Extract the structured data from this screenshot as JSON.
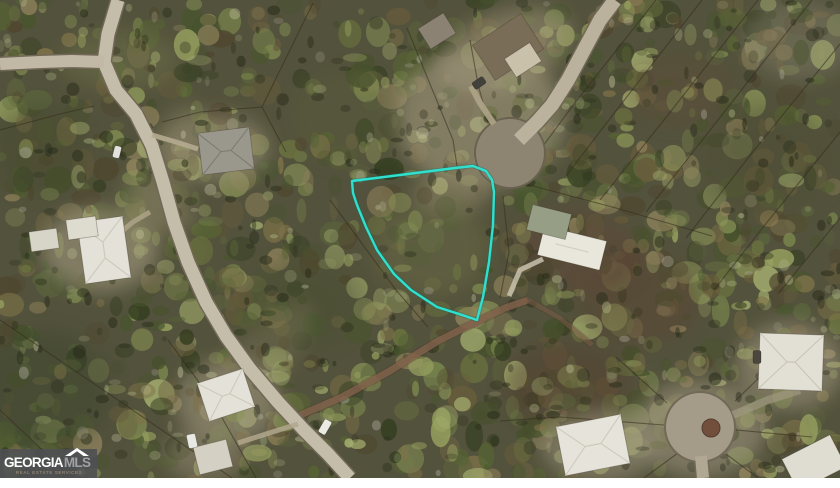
{
  "image": {
    "width": 840,
    "height": 488,
    "photo_height": 478,
    "border_color": "#ffffff"
  },
  "watermark": {
    "brand_primary": "GEORGIA",
    "brand_secondary": "MLS",
    "tagline": "REAL ESTATE SERVICES",
    "roof_icon": "roof-chevron",
    "bg_color": "#4f5054",
    "primary_color": "#ffffff",
    "secondary_color": "#9fa1a5",
    "tagline_color": "#8f8072"
  },
  "map": {
    "type": "aerial-photo",
    "base_color": "#4e4e38",
    "tint": {
      "color": "#9a9478",
      "opacity": 0.07
    },
    "texture": {
      "seed": 1337,
      "blob_count": 950,
      "canopy_count": 260,
      "shadow_count": 330,
      "highlight_count": 150,
      "palette": [
        "#66703c",
        "#51602f",
        "#75834a",
        "#3f4c26",
        "#8a9656",
        "#2f3a1d",
        "#7c7046",
        "#635838",
        "#97a25f",
        "#4b422b",
        "#a3ae6e",
        "#56603a",
        "#8d815a",
        "#42512a"
      ],
      "shadow_color": "#1d2212",
      "highlight_colors": [
        "#b6bd8d",
        "#c6c6a0",
        "#a9b184",
        "#b0ada0"
      ]
    },
    "clearings": [
      {
        "cx": 480,
        "cy": 118,
        "rx": 85,
        "ry": 70,
        "color": "#b2a88c",
        "op": 0.5,
        "rot": 0
      },
      {
        "cx": 505,
        "cy": 50,
        "rx": 70,
        "ry": 38,
        "color": "#a89c80",
        "op": 0.45,
        "rot": -20
      },
      {
        "cx": 215,
        "cy": 148,
        "rx": 55,
        "ry": 35,
        "color": "#a79d84",
        "op": 0.45,
        "rot": 0
      },
      {
        "cx": 100,
        "cy": 250,
        "rx": 58,
        "ry": 42,
        "color": "#b0a78c",
        "op": 0.5,
        "rot": 0
      },
      {
        "cx": 160,
        "cy": 205,
        "rx": 40,
        "ry": 25,
        "color": "#9a906f",
        "op": 0.35,
        "rot": 30
      },
      {
        "cx": 578,
        "cy": 252,
        "rx": 62,
        "ry": 40,
        "color": "#5d4034",
        "op": 0.5,
        "rot": 10
      },
      {
        "cx": 640,
        "cy": 300,
        "rx": 60,
        "ry": 45,
        "color": "#573d2f",
        "op": 0.4,
        "rot": 0
      },
      {
        "cx": 566,
        "cy": 385,
        "rx": 62,
        "ry": 42,
        "color": "#50372a",
        "op": 0.45,
        "rot": 0
      },
      {
        "cx": 680,
        "cy": 90,
        "rx": 55,
        "ry": 35,
        "color": "#5e4634",
        "op": 0.3,
        "rot": 0
      },
      {
        "cx": 700,
        "cy": 428,
        "rx": 66,
        "ry": 48,
        "color": "#a29983",
        "op": 0.55,
        "rot": 0
      },
      {
        "cx": 228,
        "cy": 402,
        "rx": 52,
        "ry": 42,
        "color": "#a89f87",
        "op": 0.5,
        "rot": 0
      },
      {
        "cx": 205,
        "cy": 455,
        "rx": 40,
        "ry": 26,
        "color": "#9c9279",
        "op": 0.45,
        "rot": 0
      },
      {
        "cx": 790,
        "cy": 366,
        "rx": 54,
        "ry": 44,
        "color": "#a79d86",
        "op": 0.5,
        "rot": 0
      },
      {
        "cx": 600,
        "cy": 446,
        "rx": 58,
        "ry": 36,
        "color": "#a39a83",
        "op": 0.5,
        "rot": 0
      },
      {
        "cx": 430,
        "cy": 248,
        "rx": 58,
        "ry": 48,
        "color": "#6d6e46",
        "op": 0.4,
        "rot": 0
      },
      {
        "cx": 452,
        "cy": 192,
        "rx": 38,
        "ry": 22,
        "color": "#9a9171",
        "op": 0.45,
        "rot": 0
      },
      {
        "cx": 345,
        "cy": 118,
        "rx": 55,
        "ry": 45,
        "color": "#585c38",
        "op": 0.35,
        "rot": 0
      },
      {
        "cx": 42,
        "cy": 390,
        "rx": 70,
        "ry": 60,
        "color": "#39422a",
        "op": 0.5,
        "rot": 0
      },
      {
        "cx": 770,
        "cy": 160,
        "rx": 65,
        "ry": 55,
        "color": "#49482e",
        "op": 0.4,
        "rot": 0
      },
      {
        "cx": 800,
        "cy": 40,
        "rx": 55,
        "ry": 40,
        "color": "#8d8a76",
        "op": 0.35,
        "rot": 0
      },
      {
        "cx": 300,
        "cy": 305,
        "rx": 60,
        "ry": 45,
        "color": "#424b2a",
        "op": 0.4,
        "rot": 0
      },
      {
        "cx": 120,
        "cy": 60,
        "rx": 60,
        "ry": 30,
        "color": "#7d8251",
        "op": 0.3,
        "rot": 0
      },
      {
        "cx": 40,
        "cy": 150,
        "rx": 45,
        "ry": 45,
        "color": "#3c4527",
        "op": 0.4,
        "rot": 0
      },
      {
        "cx": 160,
        "cy": 180,
        "rx": 26,
        "ry": 85,
        "color": "#8f8868",
        "op": 0.28,
        "rot": 22
      },
      {
        "cx": 255,
        "cy": 365,
        "rx": 28,
        "ry": 80,
        "color": "#8f8868",
        "op": 0.26,
        "rot": 42
      }
    ],
    "parcel_lines": {
      "color": "#2b2416",
      "width": 1.1,
      "opacity": 0.55,
      "lines": [
        [
          [
            656,
            0
          ],
          [
            574,
            104
          ],
          [
            540,
            150
          ]
        ],
        [
          [
            702,
            0
          ],
          [
            612,
            116
          ],
          [
            566,
            176
          ]
        ],
        [
          [
            758,
            0
          ],
          [
            664,
            120
          ],
          [
            600,
            200
          ]
        ],
        [
          [
            812,
            0
          ],
          [
            718,
            120
          ],
          [
            646,
            212
          ]
        ],
        [
          [
            840,
            44
          ],
          [
            748,
            158
          ],
          [
            686,
            238
          ]
        ],
        [
          [
            840,
            132
          ],
          [
            764,
            226
          ],
          [
            714,
            290
          ]
        ],
        [
          [
            840,
            218
          ],
          [
            778,
            294
          ]
        ],
        [
          [
            518,
            182
          ],
          [
            616,
            208
          ],
          [
            712,
            236
          ]
        ],
        [
          [
            503,
            196
          ],
          [
            509,
            252
          ],
          [
            500,
            298
          ]
        ],
        [
          [
            488,
            122
          ],
          [
            478,
            84
          ],
          [
            470,
            40
          ]
        ],
        [
          [
            313,
            3
          ],
          [
            262,
            107
          ],
          [
            286,
            152
          ]
        ],
        [
          [
            407,
            28
          ],
          [
            453,
            140
          ],
          [
            457,
            166
          ]
        ],
        [
          [
            262,
            107
          ],
          [
            200,
            112
          ],
          [
            162,
            122
          ]
        ],
        [
          [
            0,
            320
          ],
          [
            118,
            400
          ],
          [
            232,
            478
          ]
        ],
        [
          [
            168,
            340
          ],
          [
            212,
            400
          ],
          [
            256,
            478
          ]
        ],
        [
          [
            0,
            410
          ],
          [
            36,
            444
          ],
          [
            70,
            478
          ]
        ],
        [
          [
            0,
            130
          ],
          [
            60,
            114
          ],
          [
            94,
            106
          ]
        ],
        [
          [
            330,
            200
          ],
          [
            396,
            290
          ],
          [
            428,
            327
          ]
        ],
        [
          [
            500,
            421
          ],
          [
            560,
            417
          ],
          [
            664,
            425
          ]
        ],
        [
          [
            667,
            403
          ],
          [
            616,
            357
          ]
        ],
        [
          [
            735,
            401
          ],
          [
            786,
            352
          ]
        ],
        [
          [
            678,
            453
          ],
          [
            644,
            478
          ]
        ],
        [
          [
            726,
            454
          ],
          [
            758,
            478
          ]
        ],
        [
          [
            736,
            430
          ],
          [
            812,
            437
          ]
        ]
      ]
    },
    "dirt_roads": [
      {
        "width": 7,
        "color": "#82604a",
        "opacity": 0.8,
        "points": [
          [
            298,
            416
          ],
          [
            340,
            398
          ],
          [
            388,
            372
          ],
          [
            438,
            341
          ],
          [
            478,
            321
          ],
          [
            505,
            308
          ],
          [
            528,
            300
          ]
        ]
      },
      {
        "width": 5,
        "color": "#7a5b46",
        "opacity": 0.55,
        "points": [
          [
            528,
            300
          ],
          [
            560,
            318
          ],
          [
            592,
            345
          ]
        ]
      }
    ],
    "roads": [
      {
        "name": "main-road",
        "width": 13,
        "color": "#c8c1ae",
        "casing": "#6e6655",
        "points": [
          [
            118,
            0
          ],
          [
            108,
            34
          ],
          [
            104,
            62
          ],
          [
            116,
            90
          ],
          [
            136,
            114
          ],
          [
            152,
            146
          ],
          [
            163,
            182
          ],
          [
            174,
            222
          ],
          [
            188,
            262
          ],
          [
            206,
            302
          ],
          [
            226,
            336
          ],
          [
            250,
            369
          ],
          [
            278,
            402
          ],
          [
            304,
            430
          ],
          [
            328,
            454
          ],
          [
            350,
            478
          ]
        ]
      },
      {
        "name": "west-road",
        "width": 12,
        "color": "#c4bdaa",
        "casing": "#6e6655",
        "points": [
          [
            0,
            64
          ],
          [
            40,
            62
          ],
          [
            72,
            61
          ],
          [
            104,
            62
          ]
        ]
      },
      {
        "name": "cul-de-sac-road",
        "width": 14,
        "color": "#bdb5a0",
        "casing": "#6e6655",
        "points": [
          [
            615,
            0
          ],
          [
            600,
            20
          ],
          [
            585,
            48
          ],
          [
            568,
            80
          ],
          [
            552,
            105
          ],
          [
            537,
            122
          ],
          [
            519,
            140
          ]
        ]
      },
      {
        "name": "south-road-stub",
        "width": 12,
        "color": "#b3ab97",
        "casing": "#6e6655",
        "points": [
          [
            701,
            456
          ],
          [
            703,
            478
          ]
        ]
      }
    ],
    "cul_de_sacs": [
      {
        "cx": 510,
        "cy": 153,
        "r": 34,
        "color": "#8d8473",
        "edge": "#675f4e",
        "island": null
      },
      {
        "cx": 700,
        "cy": 427,
        "r": 34,
        "color": "#a59d8a",
        "edge": "#6e6655",
        "island": {
          "cx": 711,
          "cy": 428,
          "r": 9,
          "color": "#6f4a38"
        }
      }
    ],
    "driveways": [
      {
        "width": 5,
        "color": "#b7ad92",
        "opacity": 0.9,
        "points": [
          [
            152,
            135
          ],
          [
            176,
            142
          ],
          [
            198,
            149
          ]
        ]
      },
      {
        "width": 6,
        "color": "#b0a68b",
        "opacity": 0.9,
        "points": [
          [
            494,
            124
          ],
          [
            480,
            103
          ],
          [
            471,
            86
          ]
        ]
      },
      {
        "width": 5,
        "color": "#cdc6b3",
        "opacity": 0.85,
        "points": [
          [
            509,
            296
          ],
          [
            520,
            270
          ],
          [
            543,
            259
          ]
        ]
      },
      {
        "width": 5,
        "color": "#b3a98f",
        "opacity": 0.85,
        "points": [
          [
            298,
            424
          ],
          [
            266,
            434
          ],
          [
            238,
            443
          ]
        ]
      },
      {
        "width": 5,
        "color": "#b3a98f",
        "opacity": 0.8,
        "points": [
          [
            150,
            212
          ],
          [
            133,
            222
          ],
          [
            122,
            231
          ]
        ]
      },
      {
        "width": 8,
        "color": "#a79e89",
        "opacity": 0.6,
        "points": [
          [
            733,
            415
          ],
          [
            768,
            400
          ],
          [
            800,
            390
          ]
        ]
      }
    ],
    "buildings": [
      {
        "name": "house-gray-nw",
        "cx": 226,
        "cy": 151,
        "w": 52,
        "h": 42,
        "rot": -7,
        "color": "#9a988f",
        "ridge": "#7b786f",
        "hip": true
      },
      {
        "name": "house-top-small",
        "cx": 437,
        "cy": 31,
        "w": 30,
        "h": 24,
        "rot": -32,
        "color": "#8a8275",
        "ridge": null,
        "hip": false
      },
      {
        "name": "house-top-main",
        "cx": 508,
        "cy": 47,
        "w": 58,
        "h": 42,
        "rot": -33,
        "color": "#776b57",
        "ridge": null,
        "hip": false
      },
      {
        "name": "house-top-roof-section",
        "cx": 523,
        "cy": 60,
        "w": 30,
        "h": 22,
        "rot": -33,
        "color": "#cdc5ae",
        "ridge": null,
        "hip": false
      },
      {
        "name": "house-white-west",
        "cx": 104,
        "cy": 250,
        "w": 46,
        "h": 62,
        "rot": -8,
        "color": "#e9e8e0",
        "ridge": "#cfccc0",
        "hip": true
      },
      {
        "name": "house-white-west-wing",
        "cx": 82,
        "cy": 228,
        "w": 30,
        "h": 20,
        "rot": -8,
        "color": "#e3e1d7",
        "ridge": null,
        "hip": false
      },
      {
        "name": "shed-west",
        "cx": 44,
        "cy": 240,
        "w": 28,
        "h": 20,
        "rot": -8,
        "color": "#dcdacf",
        "ridge": null,
        "hip": false
      },
      {
        "name": "house-east-white",
        "cx": 572,
        "cy": 248,
        "w": 64,
        "h": 30,
        "rot": 14,
        "color": "#efede5",
        "ridge": "#d4d1c5",
        "hip": false
      },
      {
        "name": "house-east-gable",
        "cx": 549,
        "cy": 222,
        "w": 40,
        "h": 26,
        "rot": 14,
        "color": "#97a088",
        "ridge": null,
        "hip": false
      },
      {
        "name": "house-sw",
        "cx": 226,
        "cy": 395,
        "w": 48,
        "h": 40,
        "rot": -18,
        "color": "#e9e8e0",
        "ridge": "#cfccc0",
        "hip": true
      },
      {
        "name": "shed-sw",
        "cx": 213,
        "cy": 457,
        "w": 34,
        "h": 28,
        "rot": -14,
        "color": "#d9d6ca",
        "ridge": null,
        "hip": false
      },
      {
        "name": "house-se-upper",
        "cx": 791,
        "cy": 362,
        "w": 64,
        "h": 56,
        "rot": 2,
        "color": "#e8e6dd",
        "ridge": "#cbc8bc",
        "hip": true
      },
      {
        "name": "house-se-lower",
        "cx": 593,
        "cy": 445,
        "w": 66,
        "h": 50,
        "rot": -11,
        "color": "#eceae2",
        "ridge": "#cfccc0",
        "hip": true
      },
      {
        "name": "house-se-corner",
        "cx": 814,
        "cy": 463,
        "w": 54,
        "h": 36,
        "rot": -27,
        "color": "#e5e3d9",
        "ridge": null,
        "hip": false
      }
    ],
    "vehicles": [
      {
        "cx": 325,
        "cy": 427,
        "w": 8,
        "h": 15,
        "rot": 30,
        "color": "#f1f1ec"
      },
      {
        "cx": 192,
        "cy": 441,
        "w": 9,
        "h": 14,
        "rot": -12,
        "color": "#eef0ed"
      },
      {
        "cx": 117,
        "cy": 152,
        "w": 7,
        "h": 12,
        "rot": 14,
        "color": "#e9e9e7"
      },
      {
        "cx": 479,
        "cy": 83,
        "w": 8,
        "h": 13,
        "rot": 55,
        "color": "#3d3c38"
      },
      {
        "cx": 757,
        "cy": 357,
        "w": 8,
        "h": 13,
        "rot": 0,
        "color": "#45423c"
      }
    ],
    "parcel": {
      "outline_color": "#2fe0cf",
      "under_color": "#0b6b60",
      "stroke_width": 2.4,
      "points": [
        [
          352,
          181
        ],
        [
          400,
          175
        ],
        [
          455,
          168
        ],
        [
          473,
          166
        ],
        [
          486,
          171
        ],
        [
          492,
          180
        ],
        [
          494,
          192
        ],
        [
          493,
          225
        ],
        [
          489,
          262
        ],
        [
          483,
          297
        ],
        [
          477,
          320
        ],
        [
          459,
          314
        ],
        [
          437,
          307
        ],
        [
          411,
          290
        ],
        [
          394,
          274
        ],
        [
          377,
          250
        ],
        [
          366,
          227
        ],
        [
          357,
          205
        ],
        [
          353,
          193
        ]
      ]
    }
  }
}
